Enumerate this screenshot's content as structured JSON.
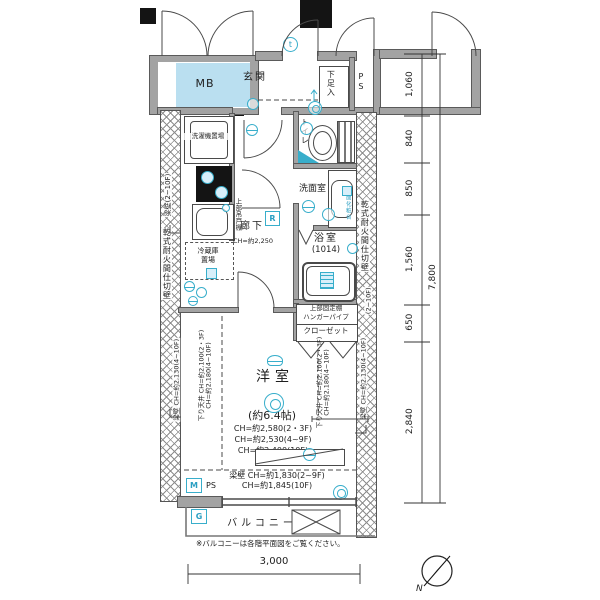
{
  "plan": {
    "rooms": {
      "mb": "MB",
      "entrance": "玄関",
      "shoe_box": "下足入",
      "pipe_space_top": "PS",
      "washer": "洗濯機置場",
      "upper_cabinet": "上部吊戸棚",
      "fridge_line1": "冷蔵庫",
      "fridge_line2": "置場",
      "hallway": "廊下",
      "hallway_ch": "CH=約2,250",
      "toilet": "トイレ",
      "washroom": "洗面室",
      "vanity": "洗面化粧台",
      "bathroom": "浴室",
      "bathroom_size": "(1014)",
      "shelf": "上部固定棚",
      "hanger_pipe": "ハンガーパイプ",
      "closet": "クローゼット",
      "living": "洋室",
      "living_size": "(約6.4帖)",
      "living_ch1": "CH=約2,580(2・3F)",
      "living_ch2": "CH=約2,530(4~9F)",
      "living_ch3": "CH=約2,400(10F)",
      "beam_ch1": "梁壁 CH=約1,830(2~9F)",
      "beam_ch2": "CH=約1,845(10F)",
      "balcony": "バルコニー",
      "pipe_space_bottom": "PS"
    },
    "marks": {
      "m": "M",
      "g": "G",
      "r": "R",
      "t": "t",
      "north": "N"
    },
    "wall_labels": {
      "left_beam_top": "梁壁(2~10F)",
      "left_partition": "乾式耐火間仕切壁",
      "left_beam_bottom": "梁壁 CH=約2,130(4~10F)",
      "right_partition": "乾式耐火間仕切壁",
      "right_floors": "(2~10F)",
      "right_beam_bottom": "梁壁 CH=約2,130(4~10F)",
      "drop_ceiling_left_1": "下り天井 CH=約2,100(2・3F)",
      "drop_ceiling_left_2": "CH=約2,180(4~10F)",
      "drop_ceiling_mid_1": "下り天井 CH=約2,100(2・3F)",
      "drop_ceiling_mid_2": "CH=約2,180(4~10F)"
    },
    "dimensions": {
      "v1": "1,060",
      "v2": "840",
      "v3": "850",
      "v4": "1,560",
      "v5": "650",
      "v6": "2,840",
      "v_total": "7,800",
      "width": "3,000"
    },
    "note": "※バルコニーは各階平面図をご覧ください。",
    "colors": {
      "accent_cyan": "#38aecb",
      "mb_fill": "#badff0",
      "wall_gray": "#a3a3a3"
    }
  }
}
